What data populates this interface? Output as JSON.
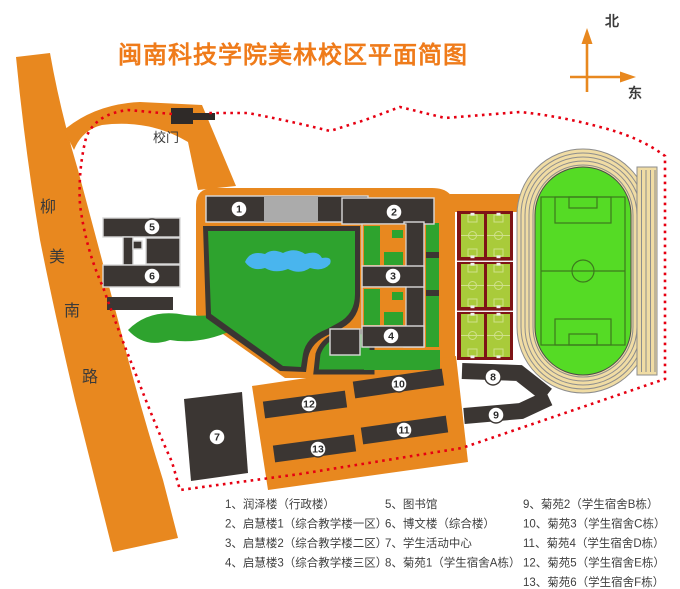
{
  "title": "闽南科技学院美林校区平面简图",
  "compass": {
    "north": "北",
    "east": "东"
  },
  "left_road": {
    "chars": [
      "柳",
      "美",
      "南",
      "路"
    ]
  },
  "gate": {
    "label": "校门"
  },
  "map": {
    "markers": [
      {
        "label": "1"
      },
      {
        "label": "2"
      },
      {
        "label": "3"
      },
      {
        "label": "4"
      },
      {
        "label": "5"
      },
      {
        "label": "6"
      },
      {
        "label": "7"
      },
      {
        "label": "8"
      },
      {
        "label": "9"
      },
      {
        "label": "10"
      },
      {
        "label": "11"
      },
      {
        "label": "12"
      },
      {
        "label": "13"
      }
    ]
  },
  "legend": {
    "columns": [
      {
        "items": [
          "1、润泽楼（行政楼）",
          "2、启慧楼1（综合教学楼一区）",
          "3、启慧楼2（综合教学楼二区）",
          "4、启慧楼3（综合教学楼三区）"
        ]
      },
      {
        "items": [
          "5、图书馆",
          "6、博文楼（综合楼）",
          "7、学生活动中心",
          "8、菊苑1（学生宿舍A栋）"
        ]
      },
      {
        "items": [
          "9、菊苑2（学生宿舍B栋）",
          "10、菊苑3（学生宿舍C栋）",
          "11、菊苑4（学生宿舍D栋）",
          "12、菊苑5（学生宿舍E栋）",
          "13、菊苑6（学生宿舍F栋）"
        ]
      }
    ]
  },
  "colors": {
    "road_orange": "#E8881F",
    "title_orange": "#EF7B1A",
    "building_dark": "#3B3633",
    "lawn_green": "#2EA32E",
    "field_green": "#55DB25",
    "track_tan": "#F0DCA4",
    "court_green": "#A9CB3A",
    "court_frame_red": "#7E1416",
    "boundary_red": "#E60012",
    "lake_blue": "#49B5EE",
    "gray_block": "#ABABAB"
  }
}
